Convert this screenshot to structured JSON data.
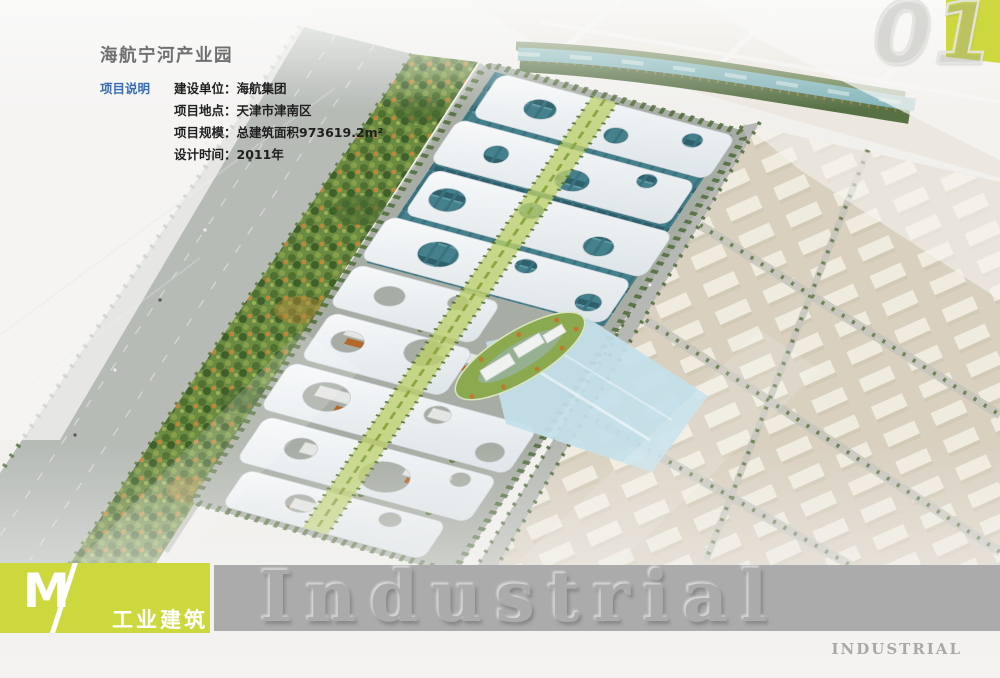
{
  "header": {
    "title": "海航宁河产业园",
    "page_number": "01",
    "page_digits": [
      "0",
      "1"
    ]
  },
  "project_info": {
    "section_label": "项目说明",
    "rows": [
      {
        "label": "建设单位：",
        "value": "海航集团"
      },
      {
        "label": "项目地点：",
        "value": "天津市津南区"
      },
      {
        "label": "项目规模：",
        "value": "总建筑面积973619.2m²"
      },
      {
        "label": "设计时间：",
        "value": "2011年"
      }
    ]
  },
  "footer": {
    "logo_letter": "M",
    "logo_slash": "/",
    "category_label": "工业建筑",
    "watermark": "Industrial",
    "corner_label": "INDUSTRIAL"
  },
  "colors": {
    "accent_green": "#ccd83e",
    "bar_gray": "#ababab",
    "label_blue": "#3a6cb4",
    "title_gray": "#707070",
    "text_dark": "#1f1f1f",
    "watermark_gray": "#ababab",
    "corner_text_gray": "#9c9c98"
  }
}
